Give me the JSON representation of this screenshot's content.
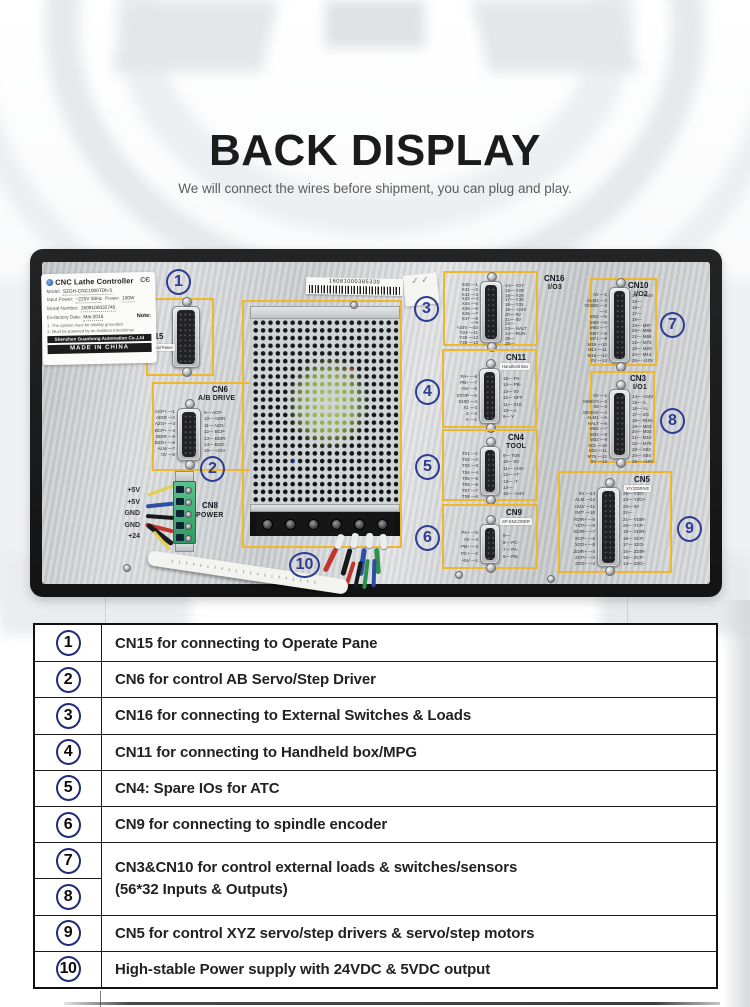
{
  "header": {
    "title": "BACK DISPLAY",
    "subtitle": "We will connect the wires before shipment, you can plug and play."
  },
  "device": {
    "nameplate": {
      "brand": "CNC Lathe Controller",
      "ce": "CЄ",
      "fields": [
        {
          "k": "Model:",
          "v": "SZGH-CNC1000TDb-5"
        },
        {
          "k": "Input Power:",
          "v": "~220V 50Hz",
          "k2": "Power:",
          "v2": "100W"
        },
        {
          "k": "Serial Number:",
          "v": "1609100032745"
        },
        {
          "k": "Ex-factory Date:",
          "v": "Mar,2016",
          "note": "Note:"
        }
      ],
      "notes": [
        "1. The system must be reliably grounded",
        "2. Must be powered by an isolation transformer"
      ],
      "company": "Shenzhen Guanhong Automation Co.,Ltd",
      "origin": "MADE IN CHINA"
    },
    "barcode": "16081000385330",
    "qc": "✓ ✓",
    "callouts": [
      "1",
      "2",
      "3",
      "4",
      "5",
      "6",
      "7",
      "8",
      "9",
      "10"
    ],
    "connectors": {
      "cn15": {
        "name": "CN15",
        "tag": "Operational Panel"
      },
      "cn6": {
        "name": "CN6",
        "sub": "A/B DRIVE",
        "pins_left": [
          "ACP+ —1",
          "ADIR —2",
          "AZO+ —3",
          "BCP+ —4",
          "BDIR —5",
          "BZO+ —6",
          "ALM —7",
          "0V —8"
        ],
        "pins_right": [
          "9— ACP-",
          "10— ADIR",
          "11— AZO-",
          "12— BCP-",
          "13— BDIR",
          "14— BZO-",
          "15— +24V"
        ]
      },
      "cn16": {
        "name": "CN16",
        "sub": "I/O3",
        "pins_left": [
          "X40 —1",
          "X41 —2",
          "X42 —3",
          "X43 —4",
          "X44 —5",
          "X45 —6",
          "X46 —7",
          "X47 —8",
          "—9",
          "+24V —10",
          "Y24 —11",
          "Y25 —12",
          "Y26 —13"
        ],
        "pins_right": [
          "14— Y27",
          "15— Y28",
          "16— Y29",
          "17— Y30",
          "18— Y31",
          "19— +24V",
          "20— 0V",
          "21— 0V",
          "22—",
          "23— HALT",
          "24— RUN",
          "25—",
          "26—"
        ]
      },
      "cn11": {
        "name": "CN11",
        "tag": "Handheld Box",
        "pins_left": [
          "PA+ —8",
          "PB+ —7",
          "+5V —6",
          "STOP —5",
          "X100 —4",
          "X1 —3",
          "Z —2",
          "X —1"
        ],
        "pins_right": [
          "15— PA-",
          "14— PB-",
          "13— 0V",
          "12— OFF",
          "11— X10",
          "10— A",
          "9— Y"
        ]
      },
      "cn4": {
        "name": "CN4",
        "sub": "TOOL",
        "pins_left": [
          "T01 —1",
          "T02 —2",
          "T03 —3",
          "T04 —4",
          "T05 —5",
          "T06 —6",
          "T07 —7",
          "T08 —8"
        ],
        "pins_right": [
          "9— TOK",
          "10— 0V",
          "11— +24V",
          "12— +T",
          "13— -T",
          "14—",
          "15— +24V"
        ]
      },
      "cn9": {
        "name": "CN9",
        "tag": "SP-ENCODER",
        "pins_left": [
          "PA+ —5",
          "0V —4",
          "PB+ —3",
          "PC+ —2",
          "+5V —1"
        ],
        "pins_right": [
          "9—",
          "8— PC-",
          "7— PA-",
          "6— PB-"
        ]
      },
      "cn10": {
        "name": "CN10",
        "sub": "I/O2",
        "pins_left": [
          "0V —1",
          "ALM2 —2",
          "#24/B0 —3",
          "—4",
          "M22 —5",
          "M59 —6",
          "M63 —7",
          "M67 —8",
          "M71 —9",
          "M18 —10",
          "M12 —11",
          "M16 —12",
          "0V —13"
        ],
        "pins_right": [
          "14— +24V",
          "15—",
          "16—",
          "17—",
          "18—",
          "19— M9*",
          "20— M95",
          "21— M69",
          "22— M73",
          "23— M29",
          "24— M14",
          "25— +10V"
        ]
      },
      "cn3": {
        "name": "CN3",
        "sub": "I/O1",
        "pins_left": [
          "0V —1",
          "M08/Y3 —2",
          "X8 —3",
          "M04/A0 —4",
          "ALM1 —5",
          "HALT —6",
          "M54 —7",
          "M34 —8",
          "M32 —9",
          "S01 —10",
          "S03 —11",
          "M75 —12",
          "0V —13"
        ],
        "pins_right": [
          "14— +24V",
          "15— -L",
          "16— +L",
          "17— ZG",
          "18— RUN",
          "19— M03",
          "20— M05",
          "21— M10",
          "22— M79",
          "23— S02",
          "24— S04",
          "25— +10V"
        ]
      },
      "cn5": {
        "name": "CN5",
        "tag": "X/Y/ZDRIVE",
        "pins_left": [
          "0V —13",
          "ALM —12",
          "+24V —11",
          "INT* —10",
          "YDIR+ —9",
          "YCP+ —8",
          "XDIR+ —7",
          "XCP+ —6",
          "XZO+ —5",
          "ZDIR+ —4",
          "ZCP+ —3",
          "ZZO+ —2"
        ],
        "pins_right": [
          "25— YZO-",
          "24— YZO+",
          "23— 0V",
          "22—",
          "21— YDIR-",
          "20— YCP-",
          "19— XDIR-",
          "18— XCP-",
          "17— XZO-",
          "16— ZDIR-",
          "15— ZCP-",
          "14— ZZO-"
        ]
      },
      "cn8": {
        "name": "CN8",
        "sub": "POWER",
        "wire_labels": [
          "+5V",
          "+5V",
          "GND",
          "GND",
          "+24"
        ]
      }
    }
  },
  "table": {
    "rows": [
      {
        "num": "1",
        "text": "CN15 for connecting to Operate Pane"
      },
      {
        "num": "2",
        "text": "CN6 for control AB Servo/Step Driver"
      },
      {
        "num": "3",
        "text": "CN16 for connecting to External Switches & Loads"
      },
      {
        "num": "4",
        "text": "CN11 for connecting to Handheld box/MPG"
      },
      {
        "num": "5",
        "text": "CN4: Spare IOs for ATC"
      },
      {
        "num": "6",
        "text": "CN9 for connecting to spindle encoder"
      },
      {
        "num": "9",
        "text": "CN5 for control XYZ servo/step drivers & servo/step motors"
      },
      {
        "num": "10",
        "text": "High-stable Power supply with 24VDC & 5VDC output"
      }
    ],
    "merged": {
      "num_top": "7",
      "num_bottom": "8",
      "line1": "CN3&CN10 for control external loads & switches/sensors",
      "line2": "(56*32 Inputs & Outputs)"
    }
  }
}
